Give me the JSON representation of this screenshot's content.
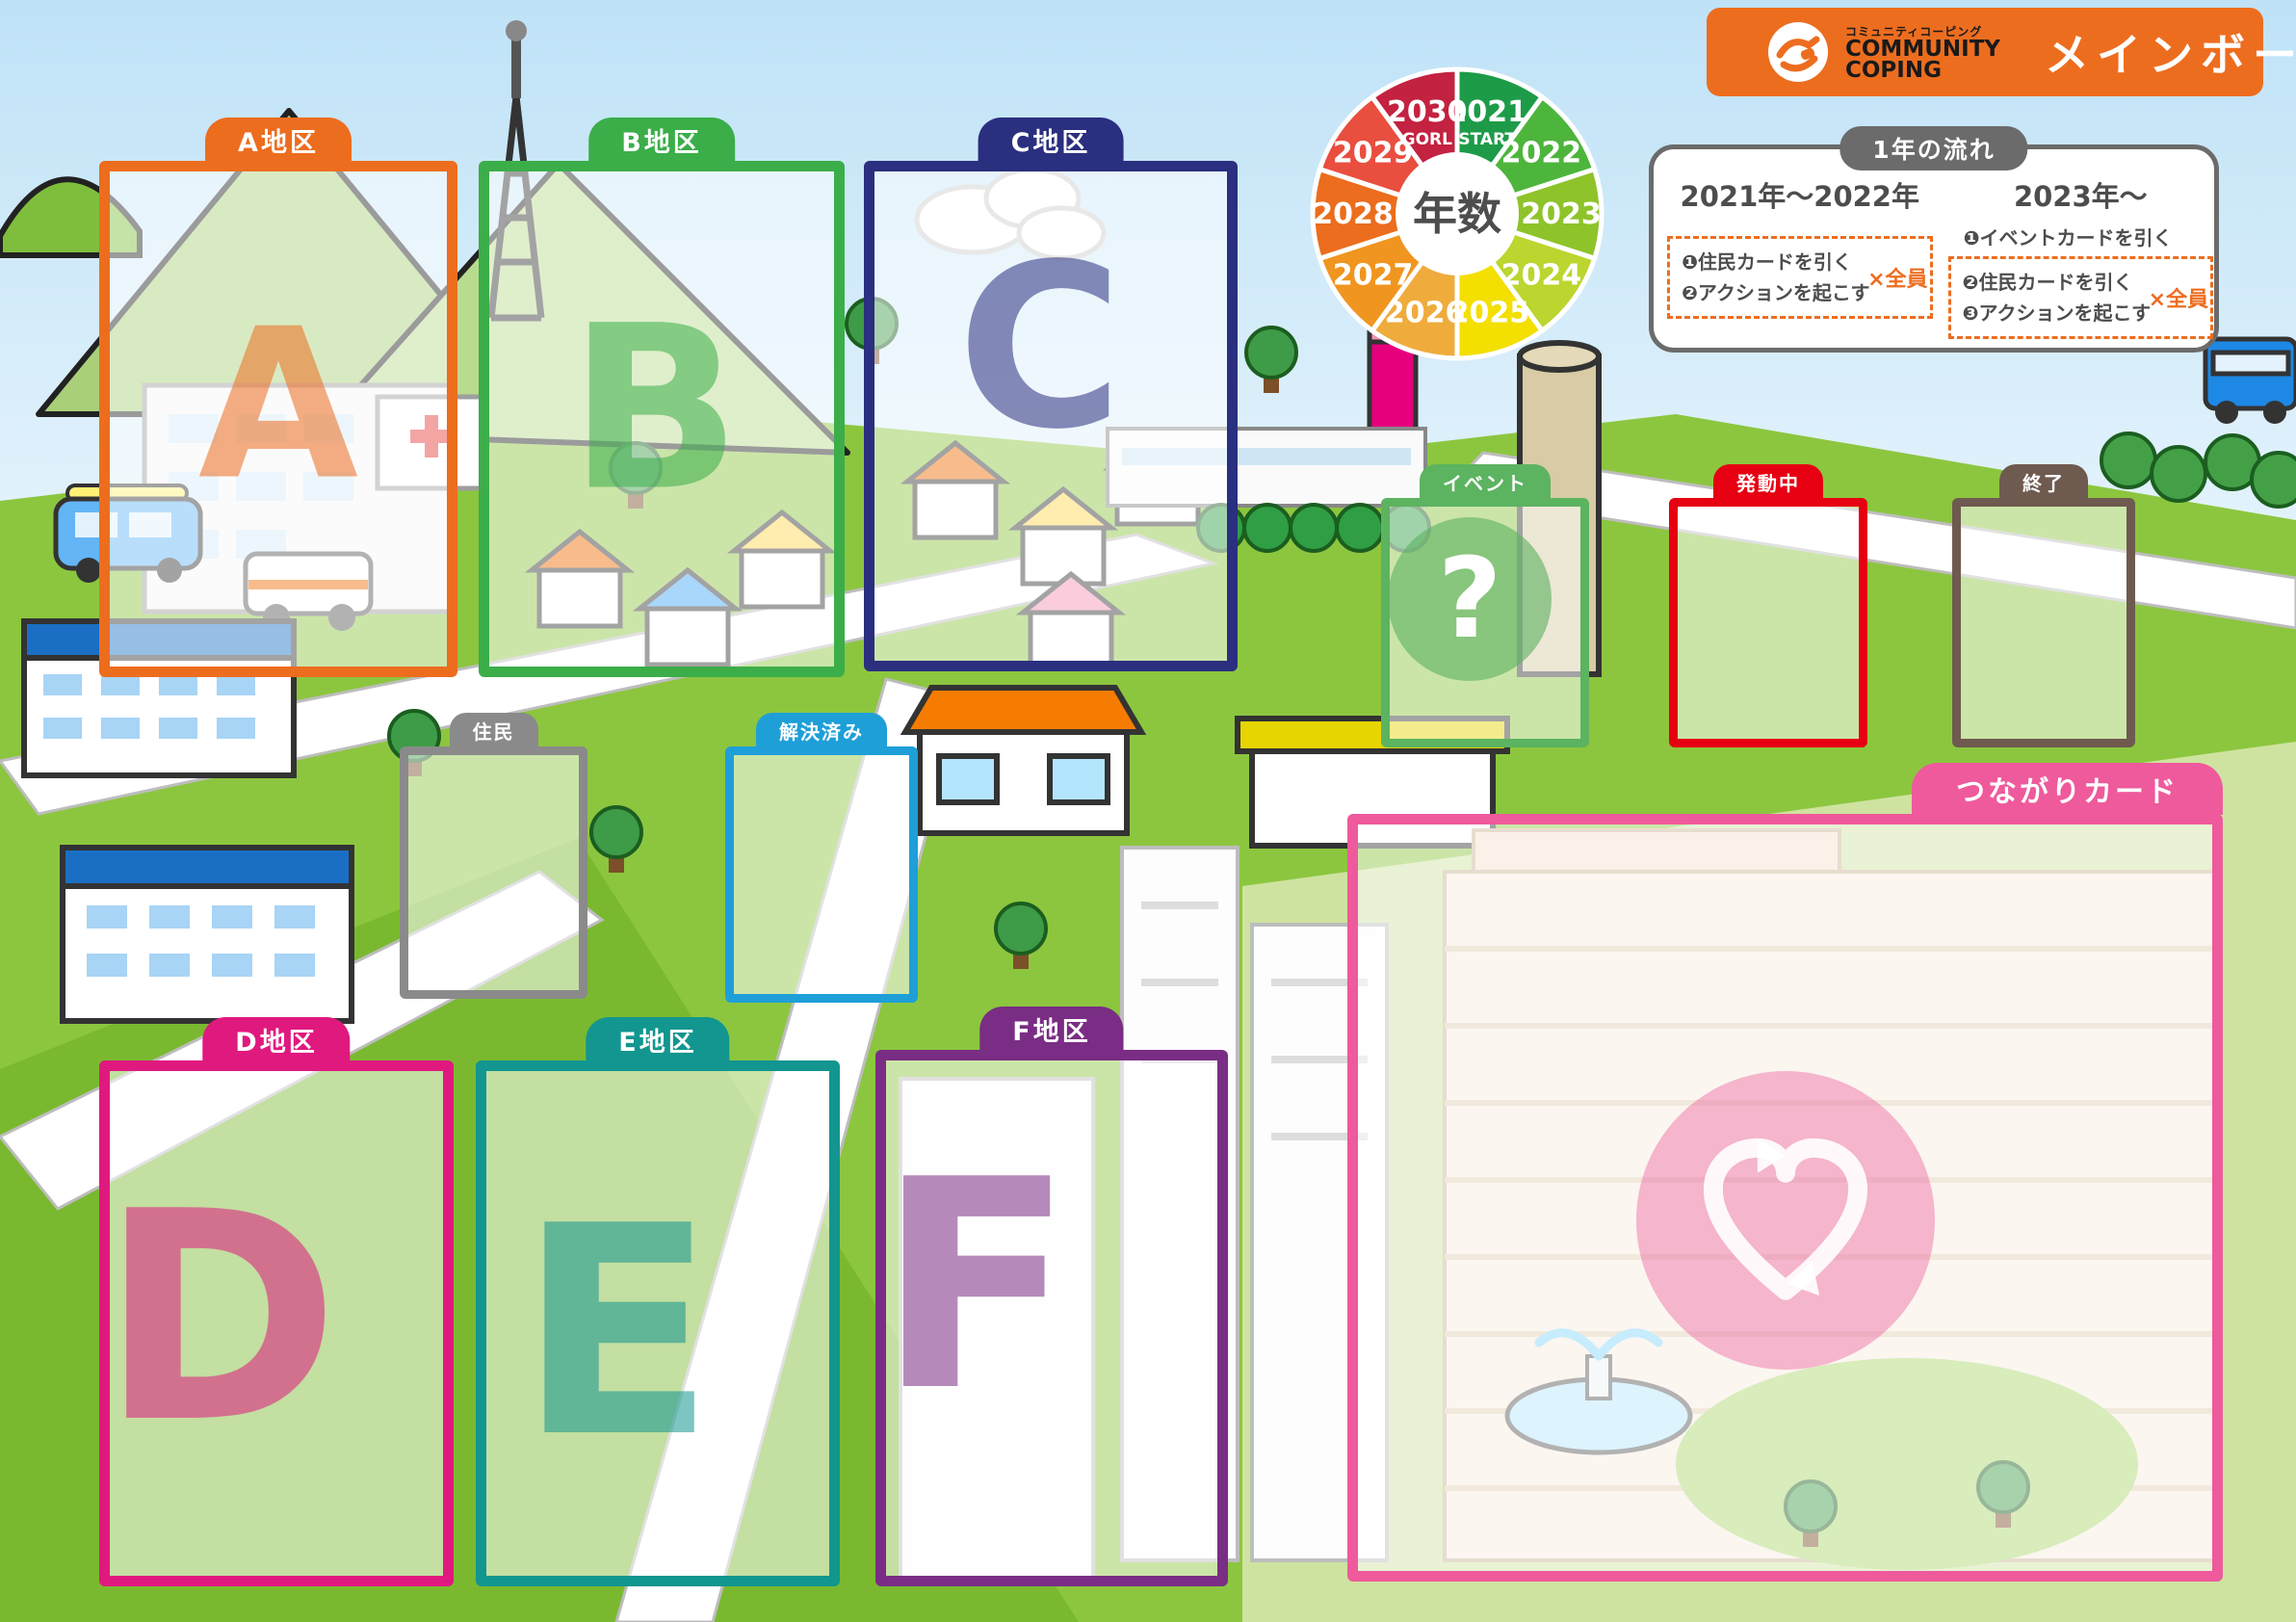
{
  "header": {
    "brand_small": "コミュニティコーピング",
    "brand_line1": "COMMUNITY",
    "brand_line2": "COPING",
    "title": "メインボード",
    "accent_color": "#ED6D1F"
  },
  "year_wheel": {
    "center_label": "年数",
    "slices": [
      {
        "year": "2021",
        "sub": "START",
        "color": "#1E9B48"
      },
      {
        "year": "2022",
        "sub": "",
        "color": "#4DB53C"
      },
      {
        "year": "2023",
        "sub": "",
        "color": "#8EC32A"
      },
      {
        "year": "2024",
        "sub": "",
        "color": "#BCD52F"
      },
      {
        "year": "2025",
        "sub": "",
        "color": "#F3DF00"
      },
      {
        "year": "2026",
        "sub": "",
        "color": "#EFAC3D"
      },
      {
        "year": "2027",
        "sub": "",
        "color": "#F0951F"
      },
      {
        "year": "2028",
        "sub": "",
        "color": "#EB6D1D"
      },
      {
        "year": "2029",
        "sub": "",
        "color": "#E94E3F"
      },
      {
        "year": "2030",
        "sub": "GORL",
        "color": "#C32240"
      }
    ]
  },
  "flow_panel": {
    "title": "1年の流れ",
    "left": {
      "heading": "2021年〜2022年",
      "steps": [
        "❶住民カードを引く",
        "❷アクションを起こす"
      ],
      "note": "×全員"
    },
    "right": {
      "heading": "2023年〜",
      "pre_step": "❶イベントカードを引く",
      "steps": [
        "❷住民カードを引く",
        "❸アクションを起こす"
      ],
      "note": "×全員"
    }
  },
  "zones": {
    "district_a": {
      "label": "A地区",
      "letter": "A",
      "color": "#ED6D1F"
    },
    "district_b": {
      "label": "B地区",
      "letter": "B",
      "color": "#3BAE49"
    },
    "district_c": {
      "label": "C地区",
      "letter": "C",
      "color": "#2A2F7F"
    },
    "district_d": {
      "label": "D地区",
      "letter": "D",
      "color": "#E0197F"
    },
    "district_e": {
      "label": "E地区",
      "letter": "E",
      "color": "#12968F"
    },
    "district_f": {
      "label": "F地区",
      "letter": "F",
      "color": "#7A2D84"
    },
    "event": {
      "label": "イベント",
      "symbol": "?",
      "color": "#5CB360"
    },
    "active": {
      "label": "発動中",
      "color": "#E60012"
    },
    "finished": {
      "label": "終了",
      "color": "#6E5A4F"
    },
    "resident": {
      "label": "住民",
      "color": "#8A8A8A"
    },
    "resolved": {
      "label": "解決済み",
      "color": "#1E9FD8"
    },
    "connection": {
      "label": "つながりカード",
      "color": "#EE5A9C"
    }
  }
}
